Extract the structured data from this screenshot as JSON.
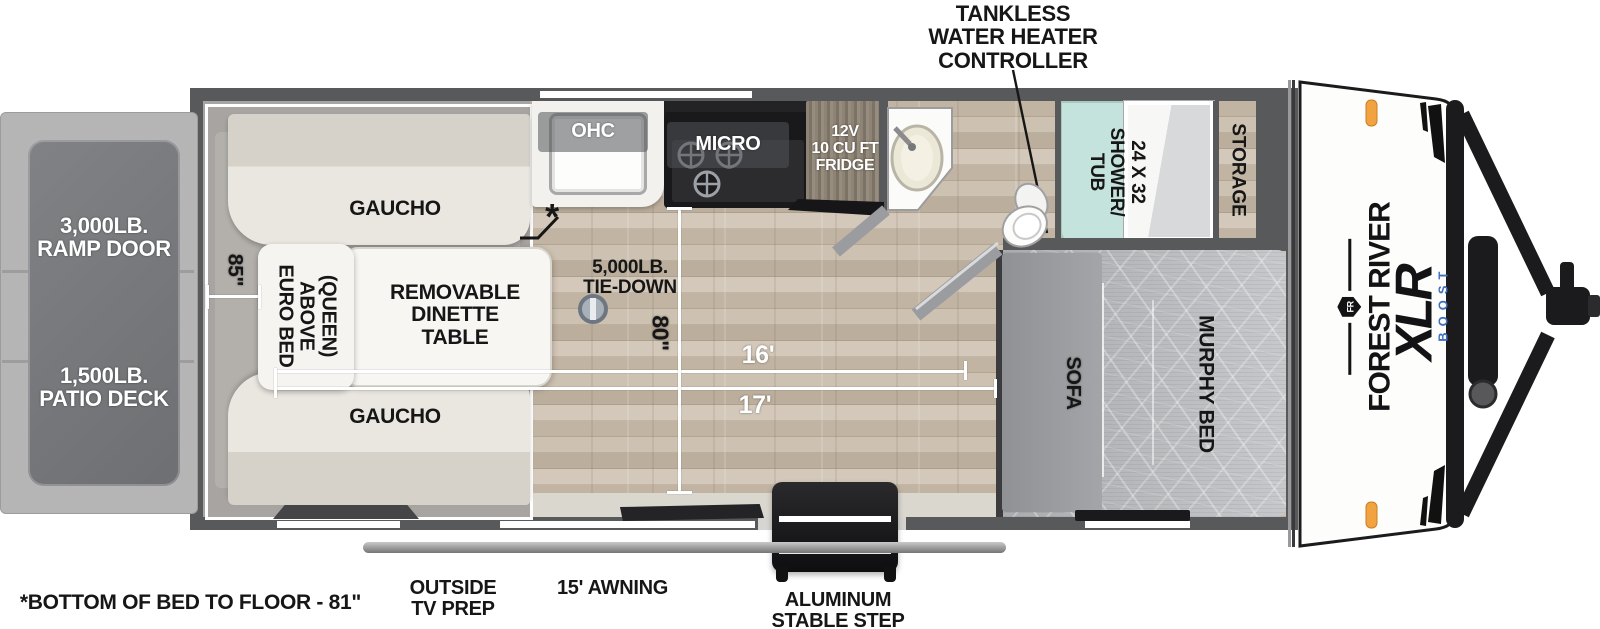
{
  "title": "Forest River XLR Boost toy hauler floorplan",
  "colors": {
    "wall": "#58595b",
    "wood_floor": "#c7bbab",
    "garage_floor": "#a7a4a1",
    "gaucho": "#e9e6df",
    "shower_teal": "#c5e3dd",
    "accent_orange": "#f2a341",
    "boost_blue": "#3f6fc1",
    "dimension_white": "#ffffff",
    "cap_black": "#1b1b1d"
  },
  "callouts": {
    "tankless": {
      "lines": [
        "TANKLESS",
        "WATER HEATER",
        "CONTROLLER"
      ]
    },
    "bottom_bed_note": "*BOTTOM OF BED TO FLOOR - 81\"",
    "outside_tv_prep": {
      "lines": [
        "OUTSIDE",
        "TV PREP"
      ]
    },
    "awning": "15' AWNING",
    "stable_step": {
      "lines": [
        "ALUMINUM",
        "STABLE STEP"
      ]
    },
    "asterisk": "*"
  },
  "exterior": {
    "ramp_door": {
      "lines": [
        "3,000LB.",
        "RAMP DOOR"
      ]
    },
    "patio_deck": {
      "lines": [
        "1,500LB.",
        "PATIO DECK"
      ]
    }
  },
  "garage": {
    "gaucho_top": "GAUCHO",
    "gaucho_bottom": "GAUCHO",
    "euro_bed": {
      "lines": [
        "EURO BED",
        "ABOVE",
        "(QUEEN)"
      ]
    },
    "dinette": {
      "lines": [
        "REMOVABLE",
        "DINETTE",
        "TABLE"
      ]
    },
    "tie_down": {
      "lines": [
        "5,000LB.",
        "TIE-DOWN"
      ]
    }
  },
  "kitchen": {
    "ohc": "OHC",
    "micro": "MICRO",
    "fridge": {
      "lines": [
        "12V",
        "10 CU FT",
        "FRIDGE"
      ]
    }
  },
  "bathroom": {
    "shower": {
      "lines": [
        "24 X 32",
        "SHOWER/",
        "TUB"
      ]
    }
  },
  "bedroom": {
    "storage": "STORAGE",
    "murphy_bed": "MURPHY BED",
    "sofa": "SOFA"
  },
  "front_cap": {
    "brand": "FOREST RIVER",
    "logo": "FR",
    "model": "XLR",
    "trim": "BOOST"
  },
  "dimensions": {
    "d85": "85\"",
    "d80": "80\"",
    "d16": "16'",
    "d17": "17'"
  }
}
